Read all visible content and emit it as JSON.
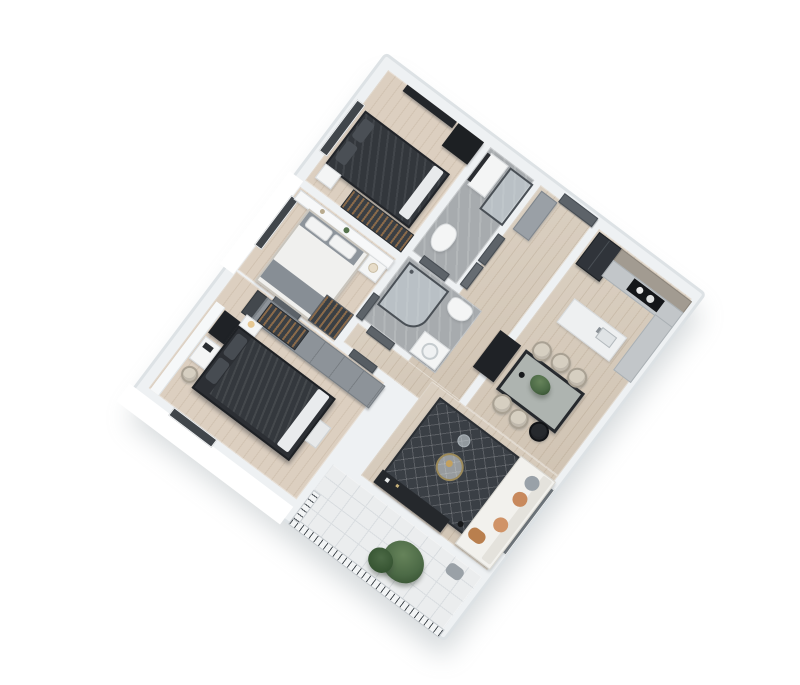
{
  "scene": {
    "type": "3d-apartment-floor-plan-render",
    "view": "axonometric top-down, plan rotated ~37 degrees clockwise on white background",
    "background": "#ffffff",
    "rotation_deg": 37
  },
  "palette": {
    "wall": "#eef1f3",
    "wall_edge": "#dde2e5",
    "wood_floor": "#d6caba",
    "bedroom_wood": "#dccfc0",
    "bath_tile": "#a7abae",
    "balcony_marble": "#ebedee",
    "dark_furniture": "#26292d",
    "dark_bed": "#33373c",
    "rug": "#3a3f45",
    "sofa": "#f2f1ed",
    "pillow_orange": "#c8895c",
    "pillow_gray": "#99a1a8",
    "chair_cream": "#d6cfc1",
    "wardrobe_gray": "#8d9399",
    "plant_green": "#4c6a46",
    "door_gray": "#5d6369",
    "glass": "#cbd5db",
    "window_dark": "#41464b"
  },
  "rooms": {
    "bedroom2": {
      "name": "Small bedroom with dark bed",
      "furniture": [
        "double bed with dark duvet",
        "wall TV panel",
        "black shelving unit",
        "open wardrobe with clothes",
        "window"
      ]
    },
    "bath1": {
      "name": "Bathroom 1",
      "furniture": [
        "glass shower",
        "toilet",
        "vanity",
        "mirror"
      ]
    },
    "hall": {
      "name": "Entry hall",
      "furniture": [
        "entrance door",
        "tall entry closet",
        "interior doors"
      ]
    },
    "kitchen": {
      "name": "Kitchen",
      "furniture": [
        "refrigerator",
        "wood upper cabinets",
        "black cooktop with pots",
        "counter return",
        "marble island with sink"
      ]
    },
    "dining": {
      "name": "Dining area",
      "furniture": [
        "dark-frame dining table",
        "cream chairs",
        "dark chair",
        "black sideboard",
        "green centerpiece plant"
      ]
    },
    "bath2": {
      "name": "Central bathroom",
      "furniture": [
        "glass corner shower",
        "toilet",
        "vanity with basin",
        "door"
      ]
    },
    "bedroom1": {
      "name": "Bedroom with white and gray bed",
      "furniture": [
        "bed with gray bands",
        "headboard shelf with decor",
        "nightstand",
        "open wardrobe",
        "window"
      ]
    },
    "corridor": {
      "name": "Corridor",
      "furniture": [
        "doors to rooms"
      ]
    },
    "master": {
      "name": "Master bedroom",
      "furniture": [
        "dark striped bed with white base",
        "wardrobe row with open hanging section",
        "black bookshelf",
        "white shelf wall",
        "vanity",
        "stool",
        "nightstand with lamp",
        "bench",
        "window"
      ]
    },
    "living": {
      "name": "Living room",
      "furniture": [
        "white sofa with orange and gray pillows",
        "patterned dark rug",
        "round gold coffee table",
        "glass pendant lamp",
        "floor lamp",
        "dark TV console",
        "window"
      ]
    },
    "balcony": {
      "name": "Balcony",
      "furniture": [
        "white marble tile floor",
        "railing with balusters",
        "large green plant",
        "gray cushion"
      ]
    }
  }
}
